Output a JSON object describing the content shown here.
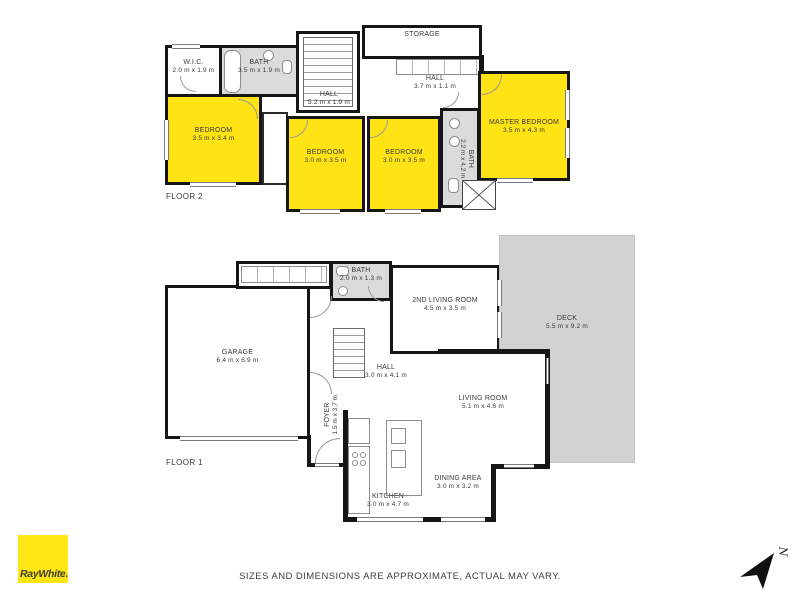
{
  "brand": {
    "logo_text": "RayWhite.",
    "logo_bg": "#ffe512"
  },
  "footer": {
    "disclaimer": "SIZES AND DIMENSIONS ARE APPROXIMATE, ACTUAL MAY VARY."
  },
  "compass": {
    "label": "N"
  },
  "colors": {
    "highlight": "#ffe314",
    "deck": "#d2d2d2",
    "bath": "#dbdbdb",
    "wall": "#161616"
  },
  "floors": [
    {
      "label": "FLOOR 2",
      "rooms": [
        {
          "name": "W.I.C.",
          "dims": "2.0 m x 1.9 m"
        },
        {
          "name": "BATH",
          "dims": "3.5 m x 1.9 m"
        },
        {
          "name": "HALL",
          "dims": "5.2 m x 1.9 m"
        },
        {
          "name": "STORAGE",
          "dims": ""
        },
        {
          "name": "HALL",
          "dims": "3.7 m x 1.1 m"
        },
        {
          "name": "BEDROOM",
          "dims": "3.5 m x 3.4 m"
        },
        {
          "name": "BEDROOM",
          "dims": "3.0 m x 3.5 m"
        },
        {
          "name": "BEDROOM",
          "dims": "3.0 m x 3.5 m"
        },
        {
          "name": "MASTER BEDROOM",
          "dims": "3.5 m x 4.3 m"
        },
        {
          "name": "BATH",
          "dims": "2.2 m x 4.2 m"
        }
      ]
    },
    {
      "label": "FLOOR 1",
      "rooms": [
        {
          "name": "GARAGE",
          "dims": "6.4 m x 6.9 m"
        },
        {
          "name": "BATH",
          "dims": "2.0 m x 1.3 m"
        },
        {
          "name": "2ND LIVING ROOM",
          "dims": "4.5 m x 3.5 m"
        },
        {
          "name": "DECK",
          "dims": "5.5 m x 9.2 m"
        },
        {
          "name": "HALL",
          "dims": "3.0 m x 4.1 m"
        },
        {
          "name": "FOYER",
          "dims": "1.5 m x 3.7 m"
        },
        {
          "name": "LIVING ROOM",
          "dims": "5.1 m x 4.6 m"
        },
        {
          "name": "DINING AREA",
          "dims": "3.0 m x 3.2 m"
        },
        {
          "name": "KITCHEN",
          "dims": "3.0 m x 4.7 m"
        }
      ]
    }
  ]
}
